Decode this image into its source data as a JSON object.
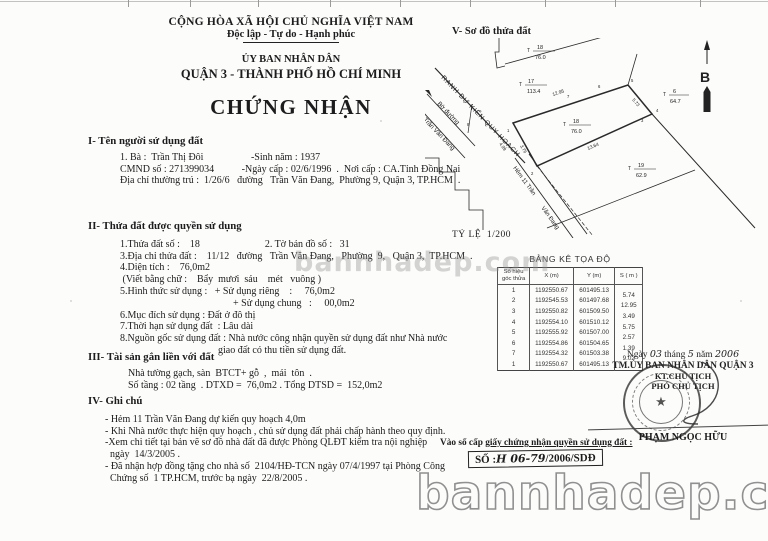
{
  "colors": {
    "ink": "#1c1c1c",
    "paper": "#fcfcfb",
    "watermark": "#909090"
  },
  "header": {
    "country": "CỘNG HÒA XÃ HỘI CHỦ NGHĨA VIỆT NAM",
    "motto": "Độc lập - Tự do - Hạnh phúc",
    "issuer": "ỦY BAN NHÂN DÂN",
    "issuer_locality": "QUẬN 3 - THÀNH PHỐ HỒ CHÍ MINH",
    "title": "CHỨNG NHẬN"
  },
  "section1": {
    "heading": "I- Tên người sử dụng đất",
    "line1": "1. Bà :  Trần Thị Đôi                   -Sinh năm : 1937",
    "line2": "CMND số : 271399034           -Ngày cấp : 02/6/1996  .  Nơi cấp : CA.Tỉnh Đồng Nai",
    "line3": "Địa chỉ thường trú :  1/26/6   đường   Trần Văn Đang,  Phường 9, Quận 3, TP.HCM  ."
  },
  "section2": {
    "heading": "II- Thửa đất được quyền sử dụng",
    "lines": [
      "1.Thửa đất số :    18                          2. Tờ bản đồ số :   31",
      "3.Địa chỉ thửa đất :    11/12   đường   Trần Văn Đang,   Phường  9,   Quận 3,  TP.HCM  .",
      "4.Diện tích :    76,0m2",
      " (Viết bằng chữ :    Bẩy  mươi  sáu    mét   vuông )",
      "5.Hình thức sử dụng :   + Sử dụng riêng    :     76,0m2",
      "+ Sử dụng chung   :     00,0m2",
      "6.Mục đích sử dụng : Đất ở đô thị",
      "7.Thời hạn sử dụng đất  : Lâu dài",
      "8.Nguồn gốc sử dụng đất : Nhà nước công nhận quyền sử dụng đất như Nhà nước",
      "giao đất có thu tiền sử dụng đất."
    ]
  },
  "section3": {
    "heading": "III- Tài sản gắn liền với đất",
    "line1": "Nhà tường gạch, sàn  BTCT+ gỗ  ,  mái  tôn  .",
    "line2": "Số tầng : 02 tầng  . DTXD =  76,0m2 . Tổng DTSD =  152,0m2"
  },
  "section4": {
    "heading": "IV- Ghi chú",
    "notes": [
      "- Hẻm 11 Trần Văn Đang dự kiến quy hoạch 4,0m",
      "- Khi Nhà nước thực hiện quy hoạch , chủ sử dụng đất phải chấp hành theo quy định.",
      "-Xem chi tiết tại bản vẽ sơ đồ nhà đất đã được Phòng QLĐT kiểm tra nội nghiệp",
      "  ngày  14/3/2005 .",
      "- Đã nhận hợp đồng tặng cho nhà số  2104/HĐ-TCN ngày 07/4/1997 tại Phòng Công",
      "  Chứng số  1 TP.HCM, trước bạ ngày  22/8/2005 ."
    ]
  },
  "diagram": {
    "heading": "V- Sơ đồ thửa đất",
    "scale": "TỶ LỆ  1/200",
    "north_label": "B",
    "boundary_label": "RANH DỰ KIẾN QUY HOẠCH",
    "road_edge_label": "Bờ đường",
    "road_name": "Trần Văn Đang",
    "alley_label_1": "Hẻm 11 Trần",
    "alley_label_2": "Văn Đang",
    "parcel_symbol": "T",
    "parcels": [
      {
        "id": "17",
        "area": "113.4"
      },
      {
        "id": "18",
        "area": "76.0"
      },
      {
        "id": "18",
        "area": "76.0"
      },
      {
        "id": "6",
        "area": "64.7"
      },
      {
        "id": "19",
        "area": "62.9"
      }
    ],
    "dims": {
      "top": "12.95",
      "bottom": "13.64",
      "right": "5.73",
      "left": "3.76",
      "alley": "4.99"
    },
    "points": [
      "1",
      "2",
      "3",
      "4",
      "5",
      "6",
      "7",
      "8"
    ]
  },
  "coord_table": {
    "title": "BẢNG KÊ TỌA ĐỘ",
    "headers": {
      "point": "Số hiệu góc thửa",
      "x": "X (m)",
      "y": "Y (m)",
      "s": "S ( m )"
    },
    "rows": [
      {
        "p": "1",
        "x": "1192550.67",
        "y": "601495.13",
        "s": "5.74"
      },
      {
        "p": "2",
        "x": "1192545.53",
        "y": "601497.68",
        "s": "12.95"
      },
      {
        "p": "3",
        "x": "1192550.82",
        "y": "601509.50",
        "s": "3.49"
      },
      {
        "p": "4",
        "x": "1192554.10",
        "y": "601510.12",
        "s": "5.75"
      },
      {
        "p": "5",
        "x": "1192555.92",
        "y": "601507.00",
        "s": "2.57"
      },
      {
        "p": "6",
        "x": "1192554.86",
        "y": "601504.65",
        "s": "1.39"
      },
      {
        "p": "7",
        "x": "1192554.32",
        "y": "601503.38",
        "s": "9.02"
      },
      {
        "p": "1",
        "x": "1192550.67",
        "y": "601495.13",
        "s": ""
      }
    ]
  },
  "signing": {
    "d0": "Ngày ",
    "d1": "03",
    "d2": " tháng ",
    "d3": "5",
    "d4": " năm ",
    "d5": "2006",
    "authority": "TM.ỦY BAN NHÂN DÂN QUẬN 3",
    "kt": "KT.CHỦ TỊCH",
    "deputy": "PHÓ CHỦ TỊCH",
    "signer": "PHẠM NGỌC HỮU",
    "stamp_star": "★"
  },
  "registry": {
    "label_prefix": "Vào sổ cấp ",
    "label_underlined": "giấy chứng nhận quyền sử dụng đất :",
    "number_prefix": "SỐ :",
    "number_hand": "H 06-79",
    "number_suffix": "/2006/SDĐ"
  },
  "watermark": {
    "text": "bannhadep.com"
  }
}
